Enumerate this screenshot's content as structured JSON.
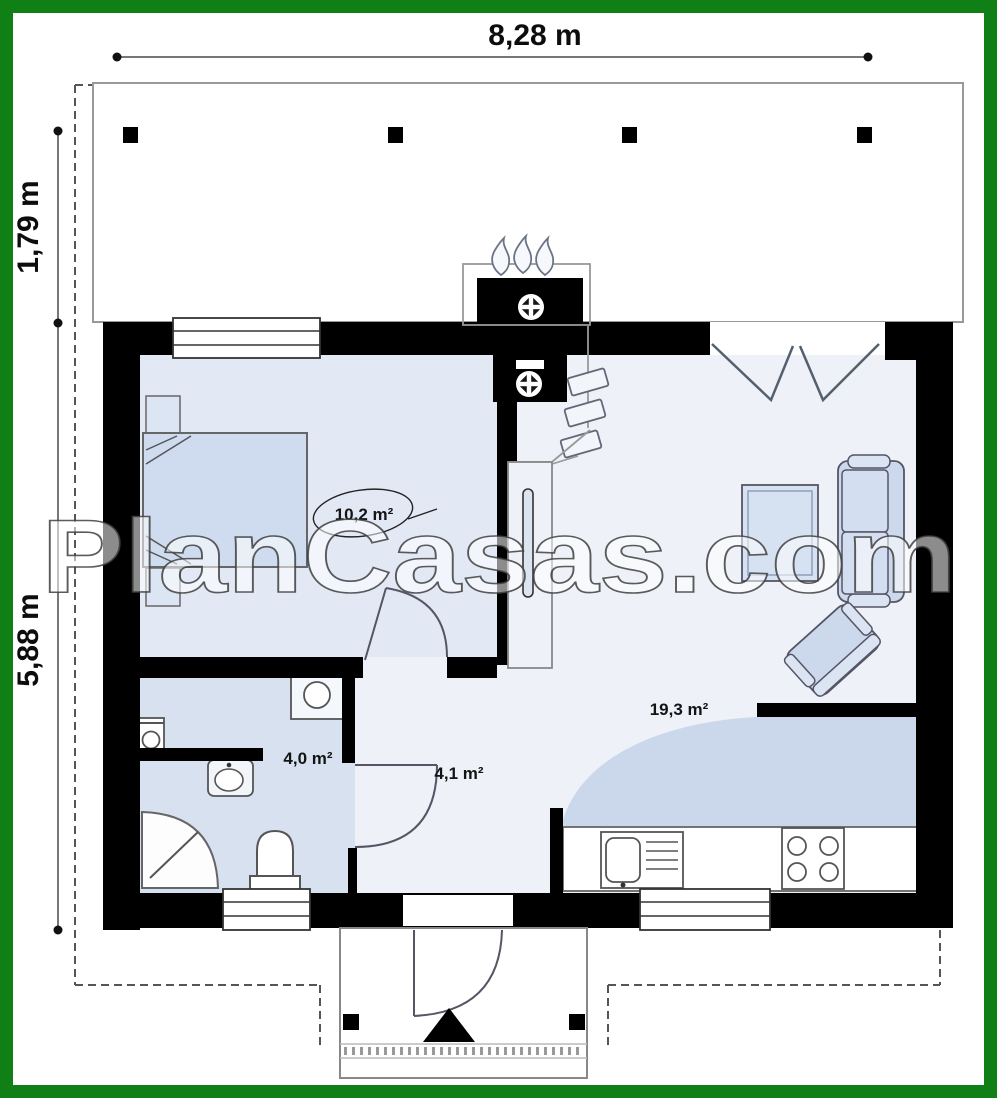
{
  "watermark": "PlanCasas.com",
  "dimensions": {
    "top": "8,28 m",
    "porch_depth": "1,79 m",
    "house_depth": "5,88 m"
  },
  "rooms": {
    "bedroom": "10,2 m²",
    "bathroom": "4,0 m²",
    "hall": "4,1 m²",
    "living": "19,3 m²"
  },
  "colors": {
    "frame": "#108016",
    "wall": "#000000",
    "floor_bedroom": "#e2e9f5",
    "floor_bathroom": "#d7e1f0",
    "floor_living": "#eef1f8",
    "floor_kitchen": "#cbd8ec",
    "furniture": "#cfdbee",
    "line": "#555555"
  }
}
